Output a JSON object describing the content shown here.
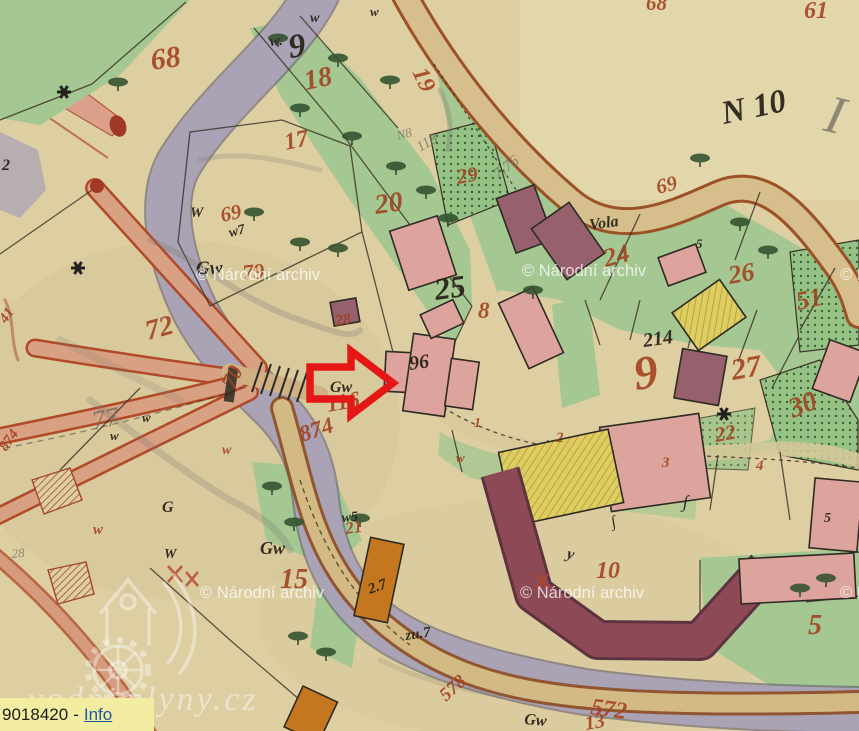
{
  "tooltip": {
    "object_id": "9018420",
    "separator": "-",
    "link_label": "Info"
  },
  "watermarks": {
    "archive": "© Národní archiv",
    "site": "vodnimlyny.cz"
  },
  "colors": {
    "paper": "#ddcfa2",
    "river": "#a9a3b5",
    "green": "#a5c791",
    "road_tan": "#d6bf8d",
    "road_edge": "#9d5127",
    "salmon_road": "#d8a183",
    "building_pink": "#dca49c",
    "building_maroon": "#96606c",
    "building_yellow": "#decd60",
    "building_orange": "#c5771f",
    "label_red": "#a2401f",
    "ink_black": "#262017",
    "arrow_red": "#e51616",
    "tooltip_bg": "#f2eda0",
    "link_blue": "#1d59a5"
  },
  "map": {
    "sheet_label": "N 10",
    "labels": [
      {
        "c": "red",
        "t": "68",
        "x": 152,
        "y": 70,
        "s": 30,
        "r": -8
      },
      {
        "c": "red",
        "t": "18",
        "x": 306,
        "y": 90,
        "s": 28,
        "r": -12
      },
      {
        "c": "red",
        "t": "19",
        "x": 412,
        "y": 72,
        "s": 24,
        "r": 65
      },
      {
        "c": "red",
        "t": "17",
        "x": 286,
        "y": 150,
        "s": 24,
        "r": -12
      },
      {
        "c": "red",
        "t": "29",
        "x": 458,
        "y": 184,
        "s": 21,
        "r": -10
      },
      {
        "c": "red",
        "t": "20",
        "x": 376,
        "y": 214,
        "s": 28,
        "r": -8
      },
      {
        "c": "red",
        "t": "69",
        "x": 222,
        "y": 222,
        "s": 21,
        "r": -12
      },
      {
        "c": "red",
        "t": "79",
        "x": 243,
        "y": 280,
        "s": 22,
        "r": -5
      },
      {
        "c": "red",
        "t": "72",
        "x": 148,
        "y": 340,
        "s": 28,
        "r": -15
      },
      {
        "c": "red",
        "t": "70",
        "x": 234,
        "y": 390,
        "s": 22,
        "r": -65
      },
      {
        "c": "red",
        "t": "116",
        "x": 328,
        "y": 412,
        "s": 23,
        "r": -10
      },
      {
        "c": "red",
        "t": "874",
        "x": 302,
        "y": 442,
        "s": 23,
        "r": -18
      },
      {
        "c": "red",
        "t": "874",
        "x": 6,
        "y": 452,
        "s": 15,
        "r": -55
      },
      {
        "c": "red",
        "t": "8",
        "x": 478,
        "y": 318,
        "s": 23,
        "r": 0
      },
      {
        "c": "red",
        "t": "28",
        "x": 336,
        "y": 326,
        "s": 16,
        "r": -10
      },
      {
        "c": "red",
        "t": "9",
        "x": 636,
        "y": 390,
        "s": 48,
        "r": -8
      },
      {
        "c": "red",
        "t": "27",
        "x": 733,
        "y": 380,
        "s": 30,
        "r": -10
      },
      {
        "c": "red",
        "t": "30",
        "x": 793,
        "y": 418,
        "s": 28,
        "r": -22
      },
      {
        "c": "red",
        "t": "51",
        "x": 798,
        "y": 310,
        "s": 26,
        "r": -12
      },
      {
        "c": "red",
        "t": "26",
        "x": 730,
        "y": 284,
        "s": 26,
        "r": -10
      },
      {
        "c": "red",
        "t": "24",
        "x": 606,
        "y": 267,
        "s": 26,
        "r": -15
      },
      {
        "c": "red",
        "t": "22",
        "x": 716,
        "y": 442,
        "s": 21,
        "r": -10
      },
      {
        "c": "red",
        "t": "69",
        "x": 658,
        "y": 194,
        "s": 21,
        "r": -14
      },
      {
        "c": "red",
        "t": "15",
        "x": 280,
        "y": 588,
        "s": 28,
        "r": 0
      },
      {
        "c": "red",
        "t": "21",
        "x": 346,
        "y": 534,
        "s": 17,
        "r": -8
      },
      {
        "c": "red",
        "t": "10",
        "x": 596,
        "y": 578,
        "s": 24,
        "r": 0
      },
      {
        "c": "red",
        "t": "5",
        "x": 808,
        "y": 634,
        "s": 28,
        "r": 0
      },
      {
        "c": "red",
        "t": "572",
        "x": 590,
        "y": 714,
        "s": 24,
        "r": 8
      },
      {
        "c": "red",
        "t": "578",
        "x": 446,
        "y": 702,
        "s": 19,
        "r": -42
      },
      {
        "c": "red",
        "t": "61",
        "x": 804,
        "y": 18,
        "s": 24,
        "r": 0
      },
      {
        "c": "red",
        "t": "68",
        "x": 646,
        "y": 10,
        "s": 21,
        "r": 0
      },
      {
        "c": "red",
        "t": "2",
        "x": 556,
        "y": 442,
        "s": 15,
        "r": 0
      },
      {
        "c": "red",
        "t": "3",
        "x": 662,
        "y": 467,
        "s": 15,
        "r": 0
      },
      {
        "c": "red",
        "t": "4",
        "x": 756,
        "y": 470,
        "s": 15,
        "r": 0
      },
      {
        "c": "red",
        "t": "1",
        "x": 474,
        "y": 427,
        "s": 14,
        "r": 0
      },
      {
        "c": "red",
        "t": "13",
        "x": 586,
        "y": 730,
        "s": 20,
        "r": -10
      },
      {
        "c": "red",
        "t": "w",
        "x": 93,
        "y": 534,
        "s": 15,
        "r": 0
      },
      {
        "c": "red",
        "t": "w",
        "x": 222,
        "y": 454,
        "s": 14,
        "r": 0
      },
      {
        "c": "red",
        "t": "w",
        "x": 456,
        "y": 462,
        "s": 13,
        "r": 0
      },
      {
        "c": "red",
        "t": "41",
        "x": 6,
        "y": 324,
        "s": 15,
        "r": -55
      },
      {
        "c": "black",
        "t": "N 10",
        "x": 724,
        "y": 124,
        "s": 33,
        "r": -12
      },
      {
        "c": "black",
        "t": "w.",
        "x": 270,
        "y": 46,
        "s": 15,
        "r": -5
      },
      {
        "c": "black",
        "t": "9",
        "x": 290,
        "y": 58,
        "s": 34,
        "r": -8
      },
      {
        "c": "black",
        "t": "25",
        "x": 436,
        "y": 300,
        "s": 31,
        "r": -8
      },
      {
        "c": "black",
        "t": "96",
        "x": 410,
        "y": 370,
        "s": 20,
        "r": -8
      },
      {
        "c": "black",
        "t": "214",
        "x": 644,
        "y": 347,
        "s": 20,
        "r": -8
      },
      {
        "c": "black",
        "t": "Vola",
        "x": 590,
        "y": 230,
        "s": 16,
        "r": -8
      },
      {
        "c": "black",
        "t": "Gw",
        "x": 196,
        "y": 274,
        "s": 19,
        "r": 0
      },
      {
        "c": "black",
        "t": "Gw",
        "x": 330,
        "y": 392,
        "s": 16,
        "r": 0
      },
      {
        "c": "black",
        "t": "Gw",
        "x": 260,
        "y": 554,
        "s": 18,
        "r": 0
      },
      {
        "c": "black",
        "t": "Gw",
        "x": 524,
        "y": 724,
        "s": 16,
        "r": 5
      },
      {
        "c": "black",
        "t": "W",
        "x": 190,
        "y": 217,
        "s": 15,
        "r": 0
      },
      {
        "c": "black",
        "t": "w7",
        "x": 230,
        "y": 237,
        "s": 14,
        "r": -15
      },
      {
        "c": "black",
        "t": "w",
        "x": 142,
        "y": 422,
        "s": 13,
        "r": 0
      },
      {
        "c": "black",
        "t": "w",
        "x": 110,
        "y": 440,
        "s": 13,
        "r": 0
      },
      {
        "c": "black",
        "t": "G",
        "x": 162,
        "y": 512,
        "s": 16,
        "r": 0
      },
      {
        "c": "black",
        "t": "W",
        "x": 164,
        "y": 558,
        "s": 14,
        "r": 0
      },
      {
        "c": "black",
        "t": "w5",
        "x": 342,
        "y": 522,
        "s": 14,
        "r": -5
      },
      {
        "c": "black",
        "t": "2.7",
        "x": 370,
        "y": 594,
        "s": 15,
        "r": -20
      },
      {
        "c": "black",
        "t": "zu.7",
        "x": 406,
        "y": 640,
        "s": 15,
        "r": -8
      },
      {
        "c": "black",
        "t": "2",
        "x": 2,
        "y": 170,
        "s": 16,
        "r": 0
      },
      {
        "c": "black",
        "t": "w",
        "x": 310,
        "y": 22,
        "s": 14,
        "r": 0
      },
      {
        "c": "black",
        "t": "w",
        "x": 370,
        "y": 16,
        "s": 13,
        "r": 0
      },
      {
        "c": "black",
        "t": "∫",
        "x": 682,
        "y": 507,
        "s": 18,
        "r": 10
      },
      {
        "c": "black",
        "t": "∫",
        "x": 612,
        "y": 527,
        "s": 16,
        "r": -10
      },
      {
        "c": "black",
        "t": "5",
        "x": 696,
        "y": 248,
        "s": 13,
        "r": 0
      },
      {
        "c": "black",
        "t": "5",
        "x": 824,
        "y": 522,
        "s": 14,
        "r": 0
      },
      {
        "c": "black",
        "t": "y",
        "x": 566,
        "y": 558,
        "s": 16,
        "r": 15
      },
      {
        "c": "pencil",
        "t": "7.76",
        "x": 498,
        "y": 180,
        "s": 16,
        "r": -38
      },
      {
        "c": "pencil",
        "t": "118",
        "x": 420,
        "y": 152,
        "s": 15,
        "r": -30
      },
      {
        "c": "pencil",
        "t": "N8",
        "x": 398,
        "y": 140,
        "s": 13,
        "r": -15
      },
      {
        "c": "pencil",
        "t": "77",
        "x": 94,
        "y": 430,
        "s": 27,
        "r": -12
      },
      {
        "c": "pencil",
        "t": "28",
        "x": 12,
        "y": 558,
        "s": 13,
        "r": -5
      },
      {
        "c": "pencil",
        "t": "I",
        "x": 822,
        "y": 130,
        "s": 54,
        "r": 14
      }
    ],
    "trees": [
      [
        118,
        82
      ],
      [
        278,
        38
      ],
      [
        338,
        58
      ],
      [
        390,
        80
      ],
      [
        300,
        108
      ],
      [
        352,
        136
      ],
      [
        396,
        166
      ],
      [
        426,
        190
      ],
      [
        254,
        212
      ],
      [
        300,
        242
      ],
      [
        338,
        248
      ],
      [
        448,
        218
      ],
      [
        533,
        290
      ],
      [
        700,
        158
      ],
      [
        740,
        222
      ],
      [
        768,
        250
      ],
      [
        826,
        578
      ],
      [
        800,
        588
      ],
      [
        272,
        486
      ],
      [
        294,
        522
      ],
      [
        298,
        636
      ],
      [
        326,
        652
      ],
      [
        360,
        518
      ]
    ],
    "flowers": [
      [
        64,
        92
      ],
      [
        78,
        268
      ],
      [
        724,
        414
      ]
    ]
  }
}
